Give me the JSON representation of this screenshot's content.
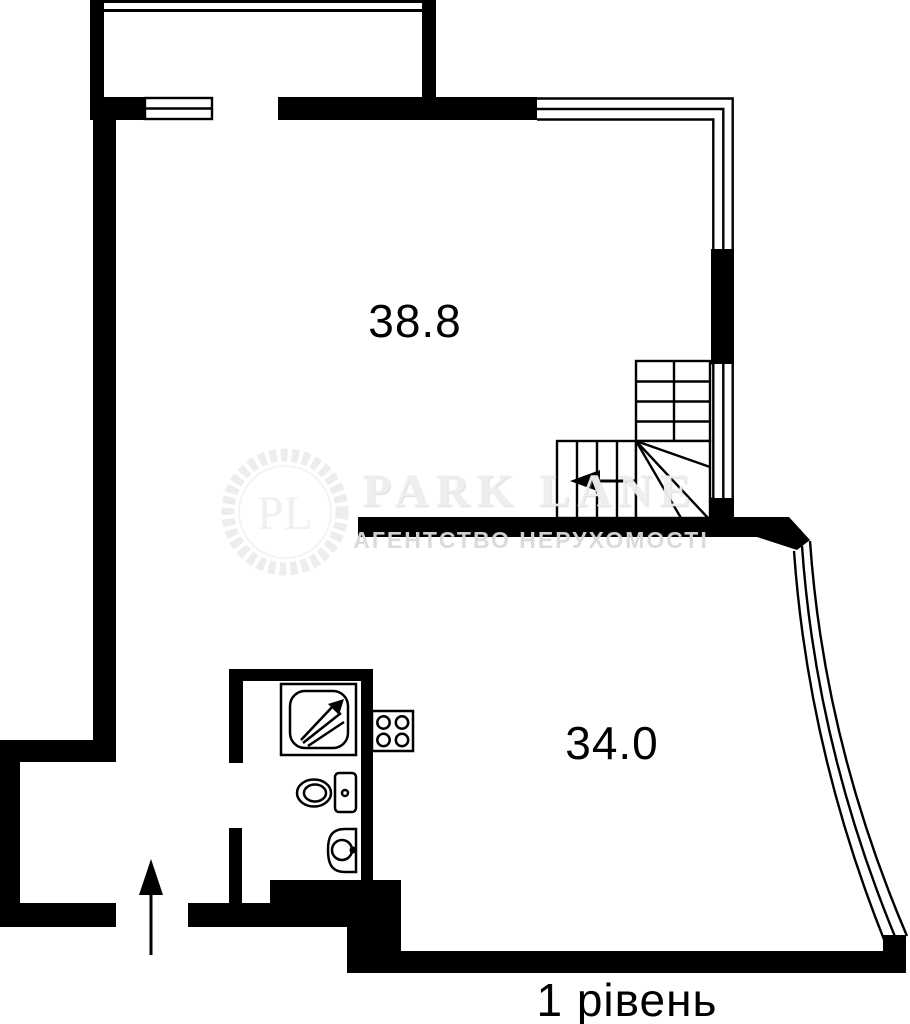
{
  "plan": {
    "title": "apartment floor plan, level 1",
    "level_label": "1 рівень",
    "rooms": [
      {
        "name": "upper-room",
        "area_label": "38.8"
      },
      {
        "name": "lower-room",
        "area_label": "34.0"
      }
    ],
    "fixtures": [
      "shower",
      "stove",
      "toilet",
      "sink",
      "winder-stairs",
      "entrance-arrow",
      "balcony",
      "corner-window",
      "curved-window"
    ]
  },
  "watermark": {
    "monogram": "PL",
    "brand": "PARK LANE",
    "tagline": "АГЕНТСТВО НЕРУХОМОСТІ"
  },
  "colors": {
    "wall": "#000000",
    "background": "#ffffff",
    "watermark_light": "#ededed",
    "watermark_text": "#d9d9d9"
  }
}
